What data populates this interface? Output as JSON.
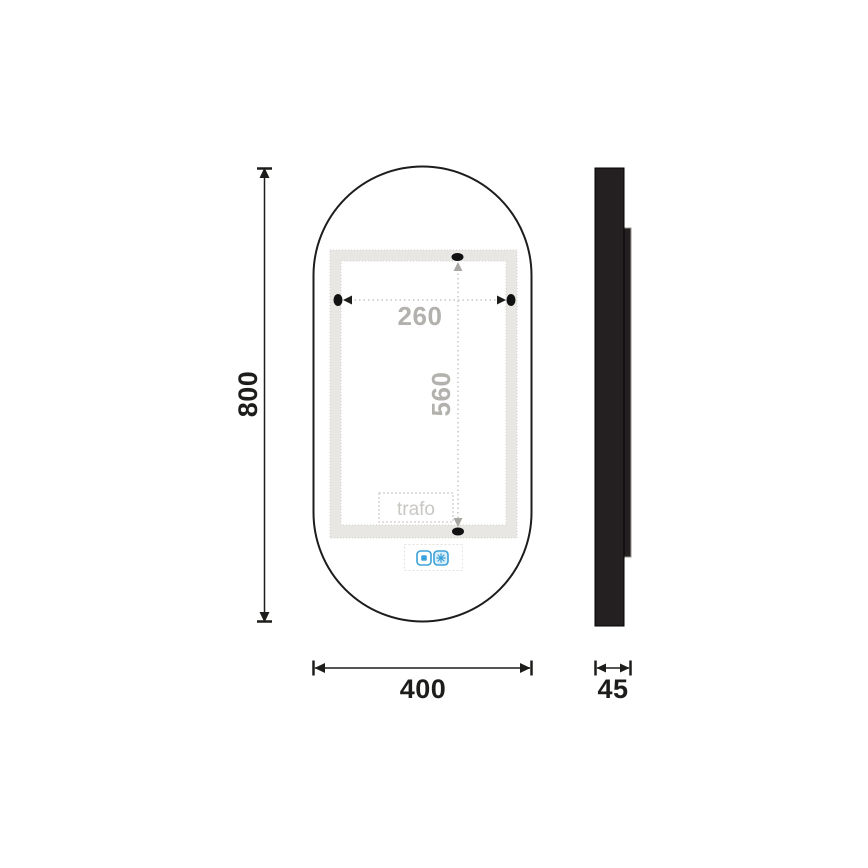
{
  "drawing": {
    "title": "oval-mirror-technical-drawing",
    "views": {
      "front": "front-view-oval-mirror",
      "side": "side-view-profile"
    }
  },
  "dimensions": {
    "height": "800",
    "width": "400",
    "depth": "45",
    "fixing_width": "260",
    "fixing_height": "560"
  },
  "labels": {
    "trafo": "trafo"
  },
  "icons": {
    "touch_switch": "touch-switch-icon",
    "anti_fog": "anti-fog-snowflake-icon"
  },
  "colors": {
    "outline": "#1d1d1b",
    "led_band": "#e9e7e4",
    "band_dot_border": "#d4d2ce",
    "dim_gray_text": "#b3b1ad",
    "dim_gray_line": "#c8c6c2",
    "gray_arrow": "#a9a7a3",
    "trafo_border": "#d8d6d2",
    "touch_box_border": "#e4e2de",
    "accent_blue": "#3ba2d9",
    "side_fill": "#242021"
  }
}
